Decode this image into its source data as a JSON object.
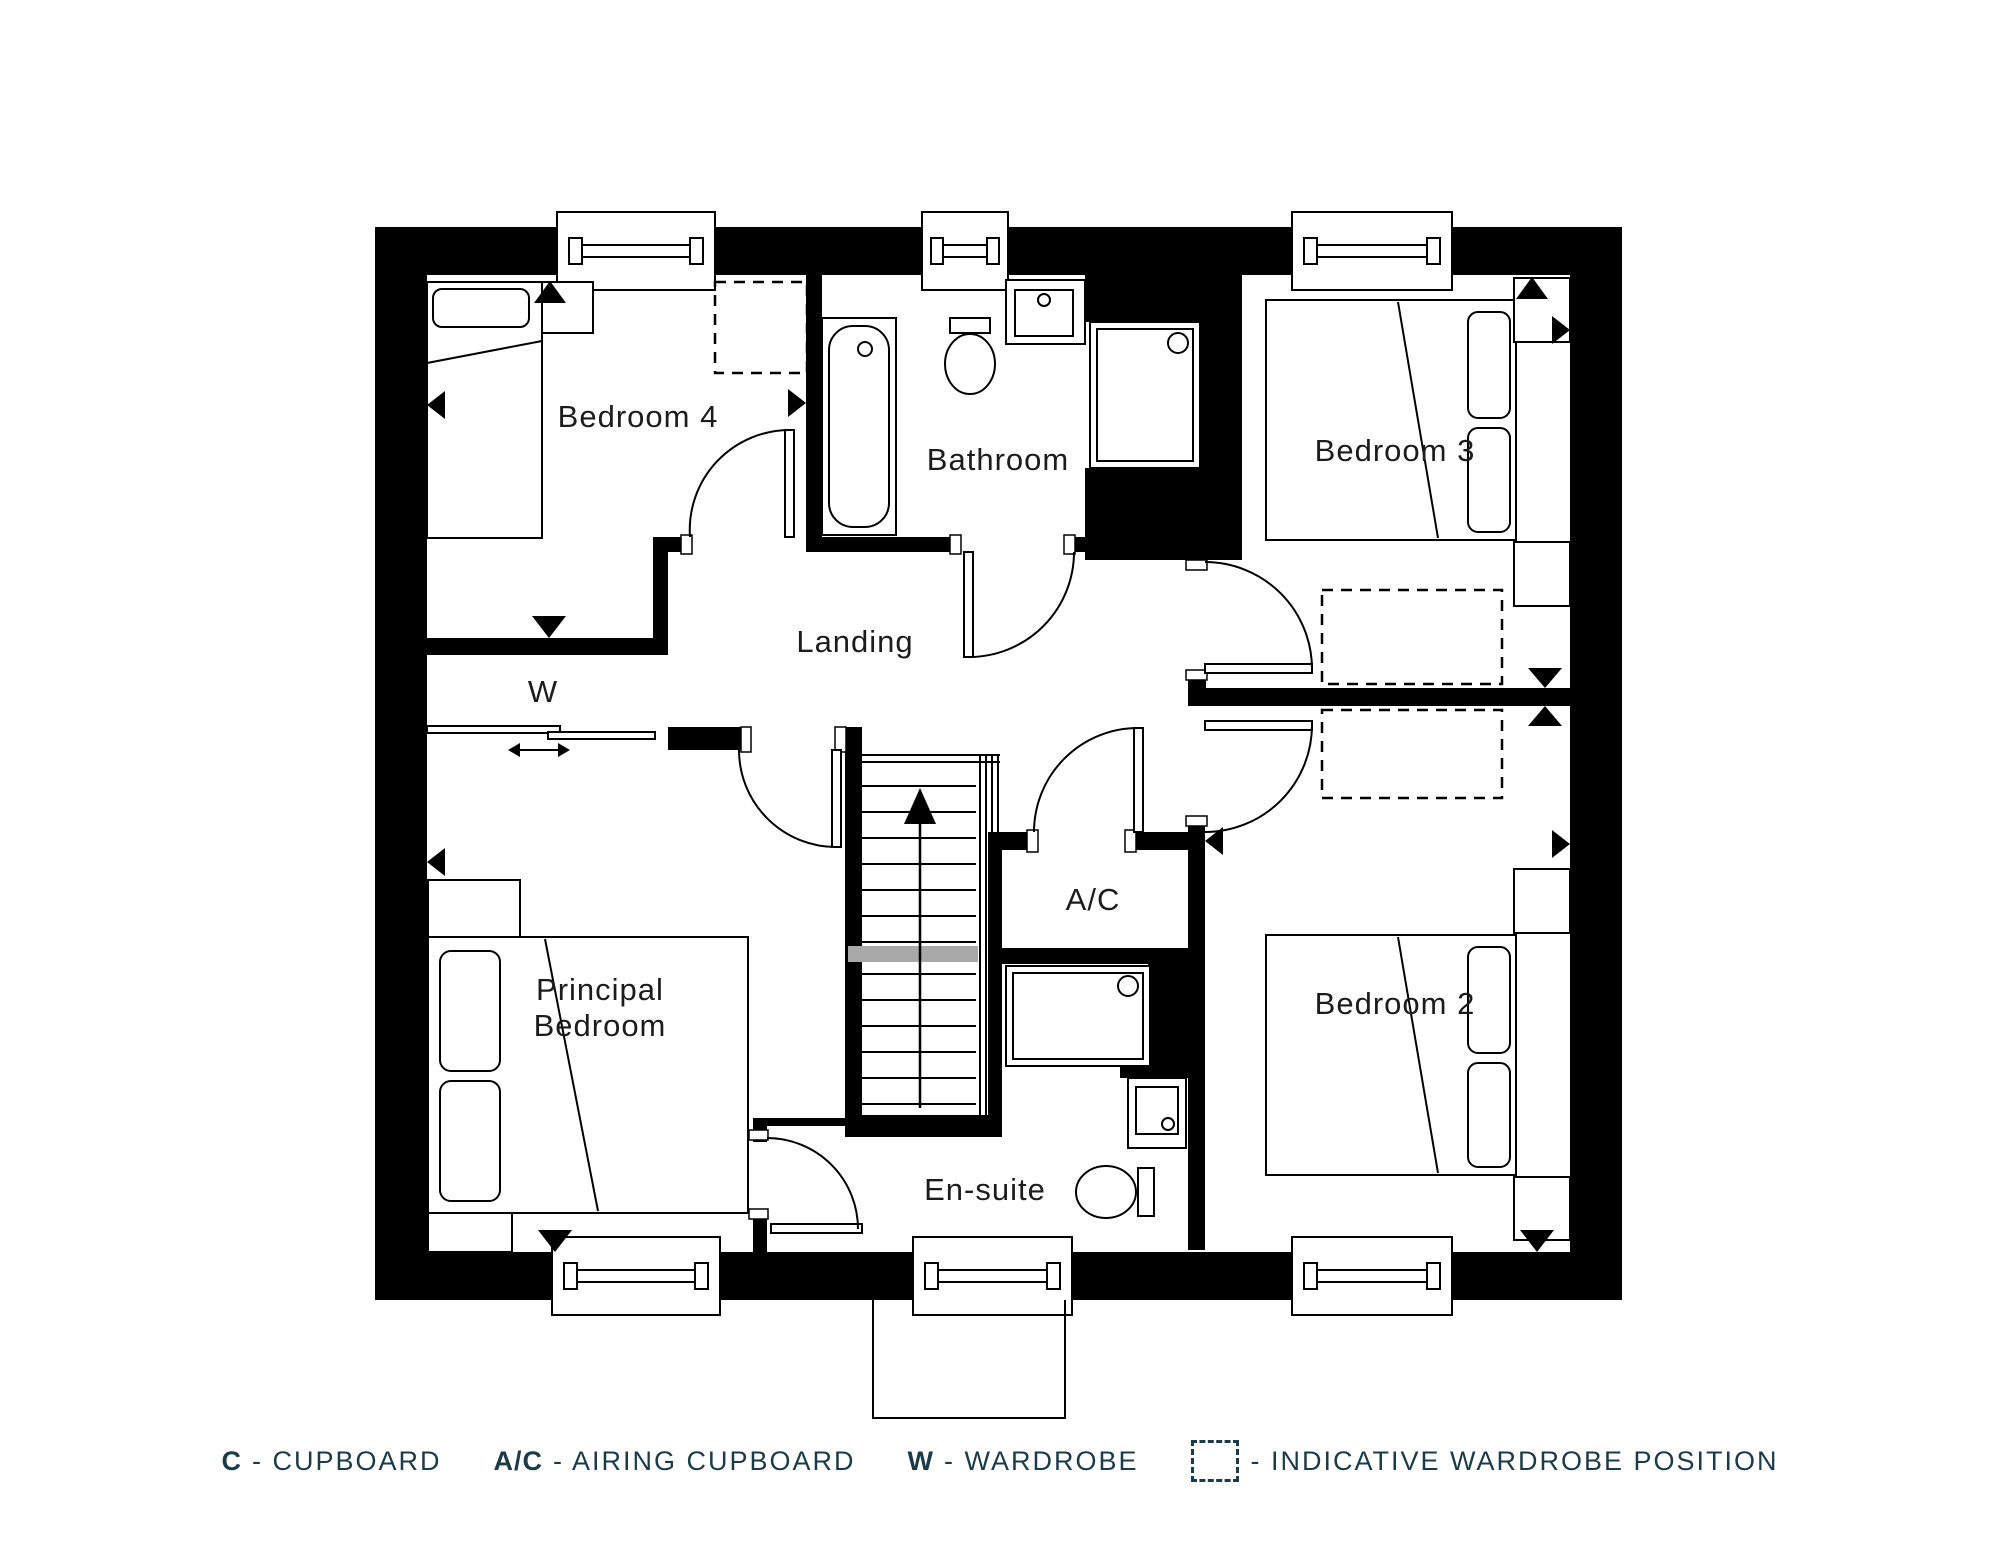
{
  "plan": {
    "rooms": {
      "bedroom4": "Bedroom 4",
      "bathroom": "Bathroom",
      "bedroom3": "Bedroom 3",
      "landing": "Landing",
      "wardrobe": "W",
      "airing_cupboard": "A/C",
      "principal_bedroom_line1": "Principal",
      "principal_bedroom_line2": "Bedroom",
      "ensuite": "En-suite",
      "bedroom2": "Bedroom 2"
    },
    "colors": {
      "walls": "#000000",
      "room_label_text": "#1c1c1c",
      "legend_text": "#1d3a47",
      "stair_cut_band": "#a9a9a9"
    },
    "icons": {
      "stairs_direction": "up-arrow",
      "wardrobe_slide": "left-right-arrow"
    }
  },
  "legend": {
    "items": [
      {
        "key": "C",
        "label": "- CUPBOARD"
      },
      {
        "key": "A/C",
        "label": "- AIRING CUPBOARD"
      },
      {
        "key": "W",
        "label": "- WARDROBE"
      },
      {
        "key": "",
        "label": "- INDICATIVE WARDROBE POSITION"
      }
    ]
  }
}
